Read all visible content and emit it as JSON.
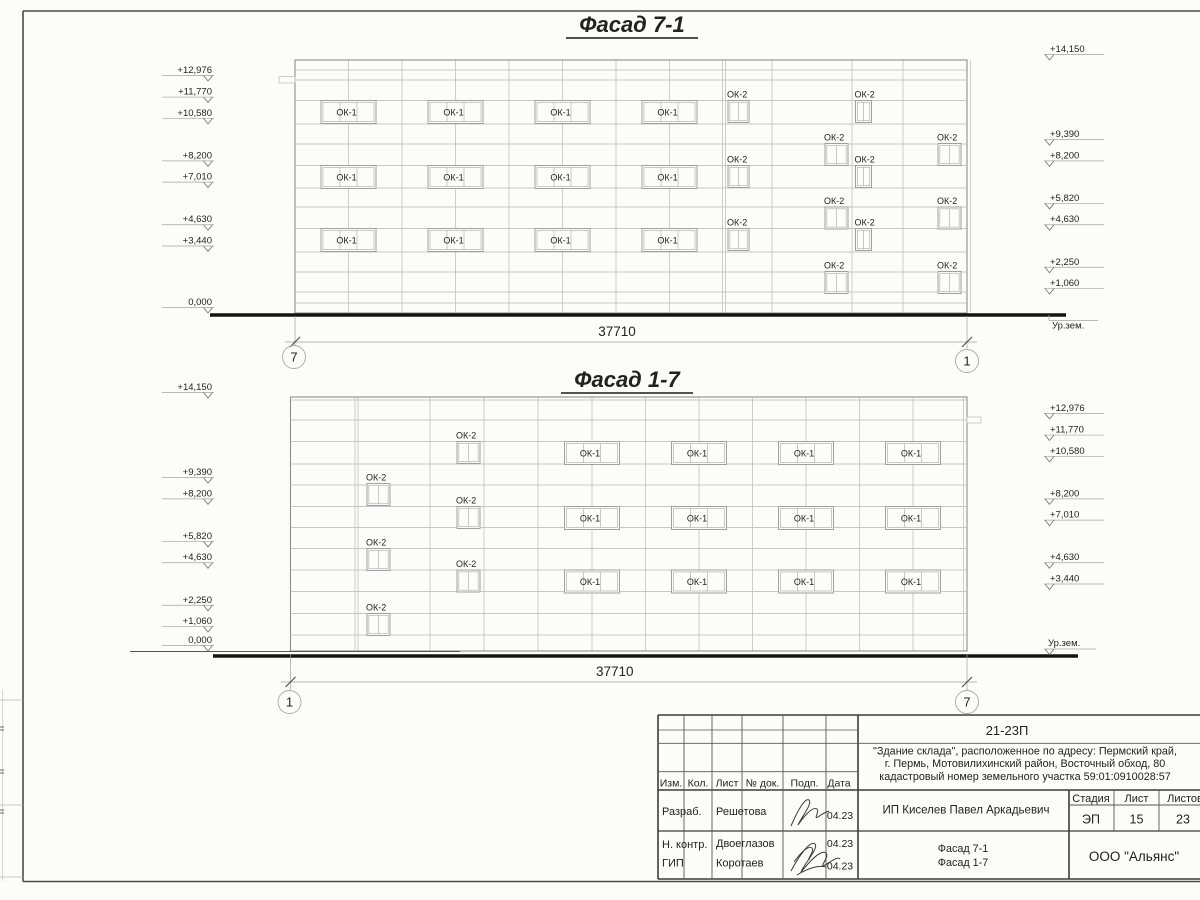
{
  "sheet": {
    "background": "#fcfcfb",
    "frame_color": "#4a4a4a",
    "line_color": "#b2b2b2",
    "ground_color": "#141414"
  },
  "facades": [
    {
      "name": "facade-7-1",
      "title": "Фасад 7-1",
      "dimension": "37710",
      "axis_left": "7",
      "axis_right": "1",
      "ground_label": "Ур.зем.",
      "window_label_ok1": "ОК-1",
      "window_label_ok2": "ОК-2",
      "marks_left": [
        "+12,976",
        "+11,770",
        "+10,580",
        "+8,200",
        "+7,010",
        "+4,630",
        "+3,440",
        "0,000"
      ],
      "marks_right": [
        "+14,150",
        "+9,390",
        "+8,200",
        "+5,820",
        "+4,630",
        "+2,250",
        "+1,060"
      ]
    },
    {
      "name": "facade-1-7",
      "title": "Фасад 1-7",
      "dimension": "37710",
      "axis_left": "1",
      "axis_right": "7",
      "ground_label": "Ур.зем.",
      "window_label_ok1": "ОК-1",
      "window_label_ok2": "ОК-2",
      "marks_left": [
        "+14,150",
        "+9,390",
        "+8,200",
        "+5,820",
        "+4,630",
        "+2,250",
        "+1,060",
        "0,000"
      ],
      "marks_right": [
        "+12,976",
        "+11,770",
        "+10,580",
        "+8,200",
        "+7,010",
        "+4,630",
        "+3,440"
      ]
    }
  ],
  "title_block": {
    "doc_number": "21-23П",
    "description_lines": [
      "\"Здание склада\", расположенное по адресу: Пермский край,",
      "г. Пермь, Мотовилихинский район, Восточный обход, 80",
      "кадастровый номер земельного участка 59:01:0910028:57"
    ],
    "revision_headers": [
      "Изм.",
      "Кол.",
      "Лист",
      "№ док.",
      "Подп.",
      "Дата"
    ],
    "signature_rows": [
      {
        "role": "Разраб.",
        "name": "Решетова",
        "date": "04.23"
      },
      {
        "role": "Н. контр.",
        "name": "Двоеглазов",
        "date": "04.23"
      },
      {
        "role": "ГИП",
        "name": "Коротаев",
        "date": "04.23"
      }
    ],
    "client": "ИП Киселев Павел Аркадьевич",
    "stage_header": "Стадия",
    "sheet_header": "Лист",
    "sheets_header": "Листов",
    "stage_value": "ЭП",
    "sheet_value": "15",
    "sheets_value": "23",
    "drawing_titles": [
      "Фасад 7-1",
      "Фасад 1-7"
    ],
    "company": "ООО \"Альянс\""
  }
}
